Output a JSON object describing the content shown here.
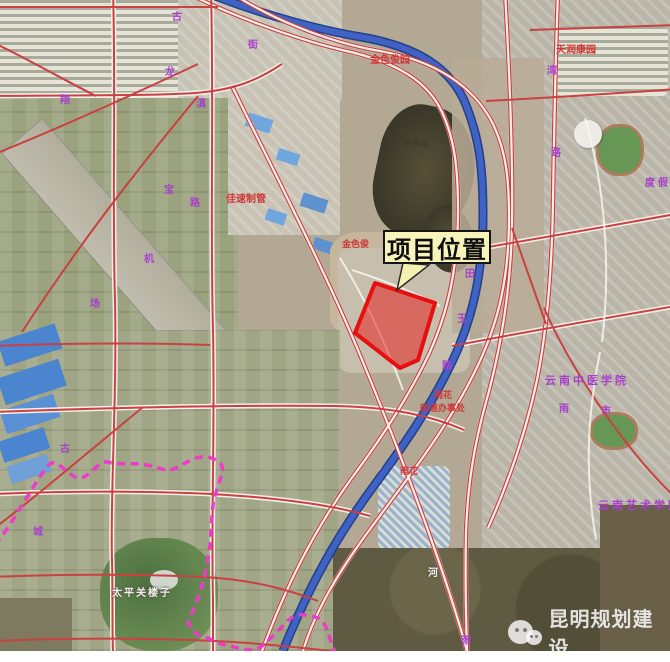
{
  "project": {
    "label": "项目位置"
  },
  "watermark": {
    "text": "昆明规划建设",
    "icon": "wechat-icon"
  },
  "labels_red": [
    {
      "text": "金色俊园"
    },
    {
      "text": "天润康园"
    },
    {
      "text": "佳速制管"
    },
    {
      "text": "金色俊"
    },
    {
      "text": "雨花"
    },
    {
      "text": "街道办事处"
    },
    {
      "text": "雨花"
    }
  ],
  "labels_purple": [
    {
      "text": "云南中医学院"
    },
    {
      "text": "云南艺术学院"
    },
    {
      "text": "度假"
    }
  ],
  "labels_white": [
    {
      "text": "太平关楼子"
    },
    {
      "text": "河"
    }
  ],
  "labels_dark": [
    {
      "text": "牛头山"
    }
  ],
  "road_chars": [
    {
      "ch": "古"
    },
    {
      "ch": "街"
    },
    {
      "ch": "龙"
    },
    {
      "ch": "滇"
    },
    {
      "ch": "翔"
    },
    {
      "ch": "宝"
    },
    {
      "ch": "路"
    },
    {
      "ch": "机"
    },
    {
      "ch": "场"
    },
    {
      "ch": "古"
    },
    {
      "ch": "城"
    },
    {
      "ch": "湾"
    },
    {
      "ch": "路"
    },
    {
      "ch": "田"
    },
    {
      "ch": "玉"
    },
    {
      "ch": "路"
    },
    {
      "ch": "雨"
    },
    {
      "ch": "市"
    },
    {
      "ch": "雨"
    }
  ],
  "colors": {
    "site_fill": "rgba(232,20,20,0.5)",
    "site_stroke": "#e80f0f",
    "road": "#c94141",
    "river": "#3f62c4",
    "boundary": "#ec3cc8",
    "label_bg": "#f8f3ba"
  }
}
